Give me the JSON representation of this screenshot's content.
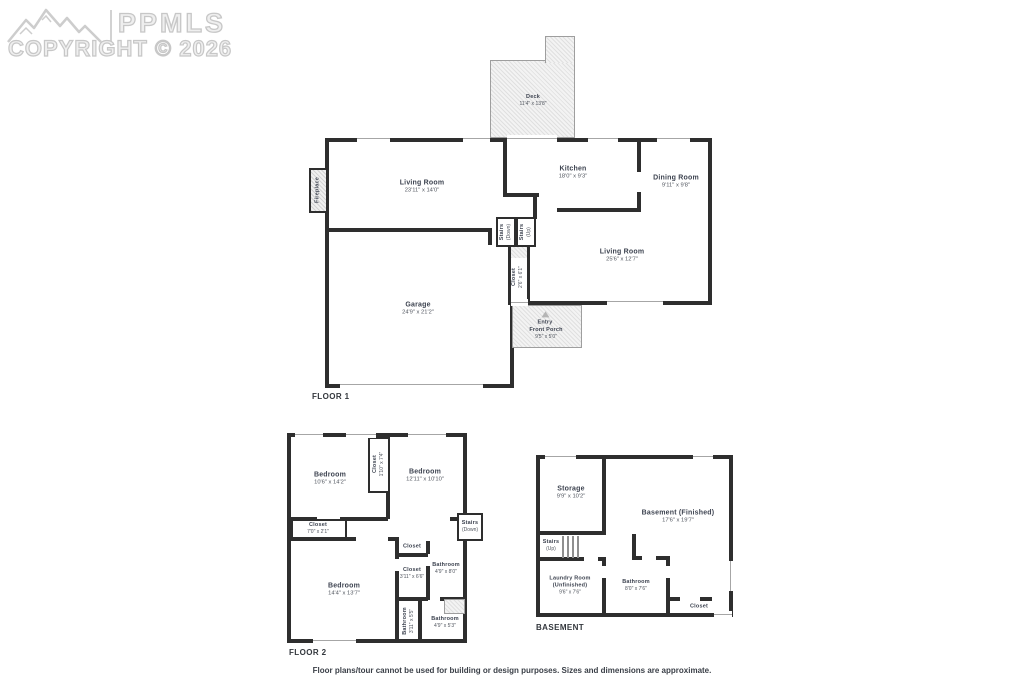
{
  "watermark": {
    "brand": "PPMLS",
    "copyright": "COPYRIGHT © 2026"
  },
  "footer": {
    "disclaimer": "Floor plans/tour cannot be used for building or design purposes. Sizes and dimensions are approximate."
  },
  "floor1": {
    "label": "FLOOR 1",
    "rooms": [
      {
        "name": "Living Room",
        "dims": "23'11\" x 14'0\""
      },
      {
        "name": "Kitchen",
        "dims": "18'0\" x 9'3\""
      },
      {
        "name": "Dining Room",
        "dims": "9'11\" x 9'8\""
      },
      {
        "name": "Living Room",
        "dims": "25'6\" x 12'7\""
      },
      {
        "name": "Garage",
        "dims": "24'9\" x 21'2\""
      },
      {
        "name": "Deck",
        "dims": "11'4\" x 13'8\""
      },
      {
        "name": "Closet",
        "dims": "2'6\" x 6'1\""
      },
      {
        "name": "Stairs",
        "dims": "(Down)"
      },
      {
        "name": "Stairs",
        "dims": "(Up)"
      },
      {
        "name": "Fireplace",
        "dims": ""
      },
      {
        "name": "Entry",
        "dims": ""
      },
      {
        "name": "Front Porch",
        "dims": "9'5\" x 5'0\""
      }
    ]
  },
  "floor2": {
    "label": "FLOOR 2",
    "rooms": [
      {
        "name": "Bedroom",
        "dims": "10'6\" x 14'2\""
      },
      {
        "name": "Closet",
        "dims": "1'10\" x 7'4\""
      },
      {
        "name": "Bedroom",
        "dims": "12'11\" x 10'10\""
      },
      {
        "name": "Closet",
        "dims": "7'0\" x 2'1\""
      },
      {
        "name": "Stairs",
        "dims": "(Down)"
      },
      {
        "name": "Closet",
        "dims": ""
      },
      {
        "name": "Closet",
        "dims": "3'11\" x 6'6\""
      },
      {
        "name": "Bathroom",
        "dims": "4'9\" x 8'0\""
      },
      {
        "name": "Bedroom",
        "dims": "14'4\" x 13'7\""
      },
      {
        "name": "Bathroom",
        "dims": "3'11\" x 5'5\""
      },
      {
        "name": "Bathroom",
        "dims": "4'9\" x 5'3\""
      }
    ]
  },
  "basement": {
    "label": "BASEMENT",
    "rooms": [
      {
        "name": "Storage",
        "dims": "9'9\" x 10'2\""
      },
      {
        "name": "Basement (Finished)",
        "dims": "17'6\" x 19'7\""
      },
      {
        "name": "Stairs",
        "dims": "(Up)"
      },
      {
        "name": "Laundry Room",
        "sub": "(Unfinished)",
        "dims": "9'6\" x 7'6\""
      },
      {
        "name": "Bathroom",
        "dims": "8'0\" x 7'6\""
      },
      {
        "name": "Closet",
        "dims": ""
      }
    ]
  }
}
